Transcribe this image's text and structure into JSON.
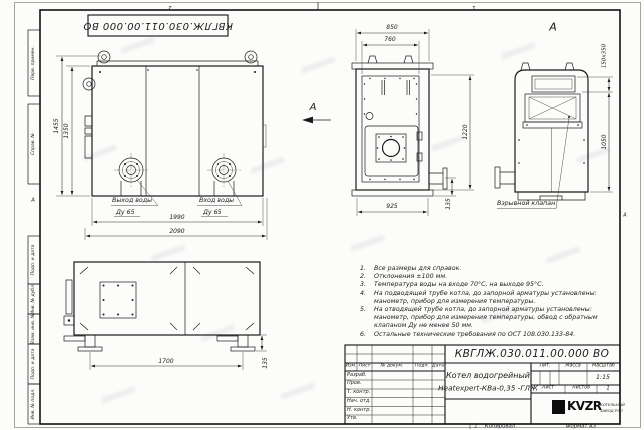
{
  "sheet": {
    "doc_number_top": "КВГЛЖ.030.011.00.000 ВО",
    "zone_left": "2",
    "zone_right": "1",
    "fold_mark_left": "А",
    "fold_mark_right": "А",
    "copy_number": "1",
    "stamps": [
      "Перв. примен.",
      "Справ. №",
      "Подп. и дата",
      "Инв. № дубл.",
      "Взам. инв. №",
      "Подп. и дата",
      "Инв. № подл."
    ]
  },
  "front_view": {
    "view_arrow_label": "А",
    "dim_height_total": "1455",
    "dim_height": "1350",
    "dim_width": "1990",
    "dim_width_total": "2090",
    "outlet_line1": "Выход воды",
    "outlet_line2": "Ду 65",
    "inlet_line1": "Вход воды",
    "inlet_line2": "Ду 65"
  },
  "side_view": {
    "dim_top_total": "850",
    "dim_top": "760",
    "dim_height": "1220",
    "dim_base": "925",
    "dim_foot": "135"
  },
  "back_view": {
    "view_label": "А",
    "dim_flue": "150х350",
    "dim_height": "1050",
    "callout": "Взрывной клапан"
  },
  "bottom_view": {
    "dim_span": "1700",
    "dim_foot": "135"
  },
  "notes": {
    "rows": [
      {
        "n": "1.",
        "t": "Все размеры для справок."
      },
      {
        "n": "2.",
        "t": "Отклонения ±100 мм."
      },
      {
        "n": "3.",
        "t": "Температура воды на входе 70°С, на выходе 95°С."
      },
      {
        "n": "4.",
        "t": "На подводящей трубе котла, до запорной арматуры установлены:"
      },
      {
        "n": "",
        "t": "манометр, прибор для измерения температуры."
      },
      {
        "n": "5.",
        "t": "На отводящей трубе котла, до запорной арматуры установлены:"
      },
      {
        "n": "",
        "t": "манометр, прибор для измерения температуры, обвод с обратным"
      },
      {
        "n": "",
        "t": "клапаном Ду не менее 50 мм."
      },
      {
        "n": "6.",
        "t": "Остальные технические требования по ОСТ 108.030.133-84."
      }
    ]
  },
  "title_block": {
    "doc_number": "КВГЛЖ.030.011.00.000 ВО",
    "product_name_line1": "Котел водогрейный",
    "product_name_line2": "Heatexpert-КВа-0,35 -ГЛЖ",
    "col_izm": "Изм.",
    "col_list": "Лист",
    "col_doc": "№ докум.",
    "col_podp": "Подп.",
    "col_data": "Дата",
    "rows": [
      "Разраб.",
      "Пров.",
      "Т. контр.",
      "Нач. отд.",
      "Н. контр.",
      "Утв."
    ],
    "lit_label": "Лит.",
    "mass_label": "Масса",
    "scale_label": "Масштаб",
    "scale_value": "1:15",
    "sheet_label": "Лист",
    "sheets_label": "Листов",
    "sheets_value": "1",
    "logo_text": "KVZR",
    "company_line1": "КОТЕЛЬНЫЙ",
    "company_line2": "ЗАВОД РЭП",
    "copied_label": "Копировал",
    "format_label": "Формат А3"
  }
}
